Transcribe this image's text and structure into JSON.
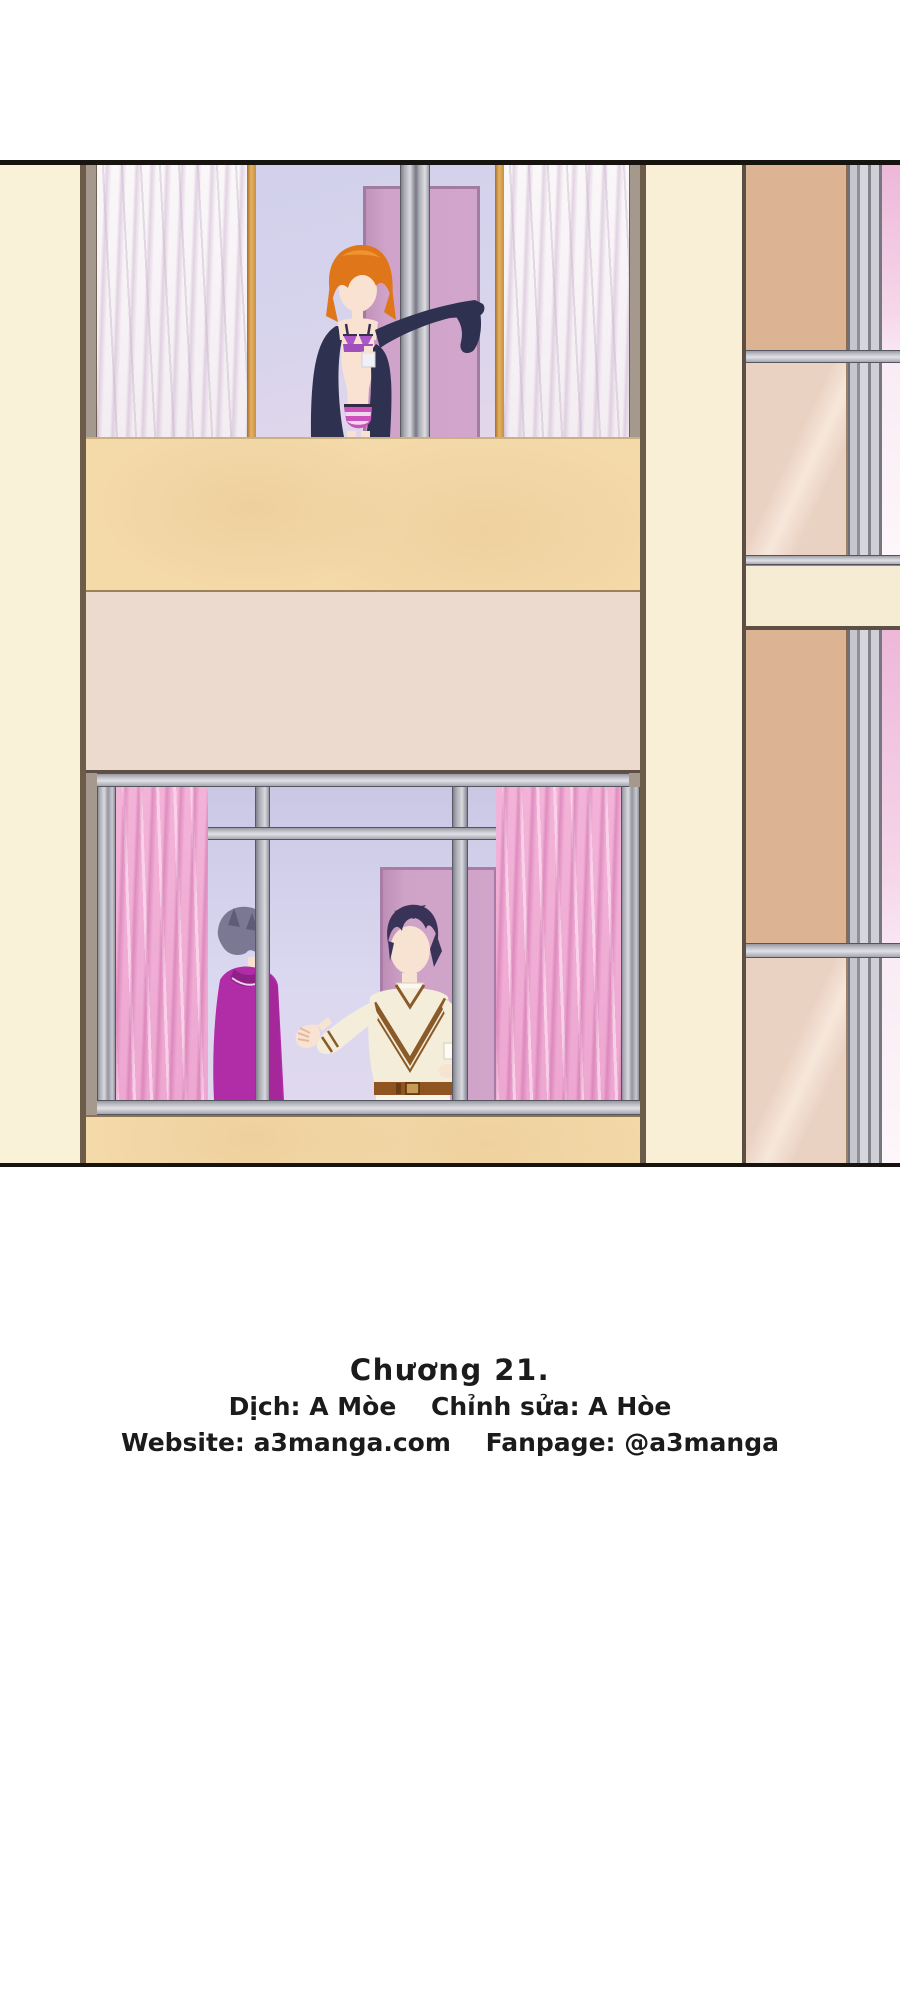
{
  "credits": {
    "chapter_title": "Chương 21.",
    "translator": "Dịch: A Mòe",
    "editor": "Chỉnh sửa: A Hòe",
    "website": "Website: a3manga.com",
    "fanpage": "Fanpage: @a3manga"
  },
  "palette": {
    "page_bg": "#ffffff",
    "panel_line": "#17140f",
    "cream_wall": "#faf1d9",
    "tan_band": "#f4d9a9",
    "pink_wall": "#ecdacf",
    "lavender_glass": "#d6d3ec",
    "gold_frame": "#d39440",
    "gray_frame": "#a8a8b2",
    "white_curtain": "#f7f2f5",
    "pink_curtain": "#f2b0d6",
    "door_pink": "#d0a3ca",
    "girl_hair": "#e0761a",
    "girl_cardigan": "#2e3150",
    "girl_underwear": "#c457b4",
    "man_left_sweater": "#b12ca7",
    "man_left_hair": "#7b7893",
    "man_right_sweater": "#f4edda",
    "man_right_hair": "#3a3358",
    "belt_brown": "#8f5420",
    "right_building_tan": "#dcb494",
    "right_building_beige": "#ead2c3",
    "text_color": "#1b1b1b"
  }
}
